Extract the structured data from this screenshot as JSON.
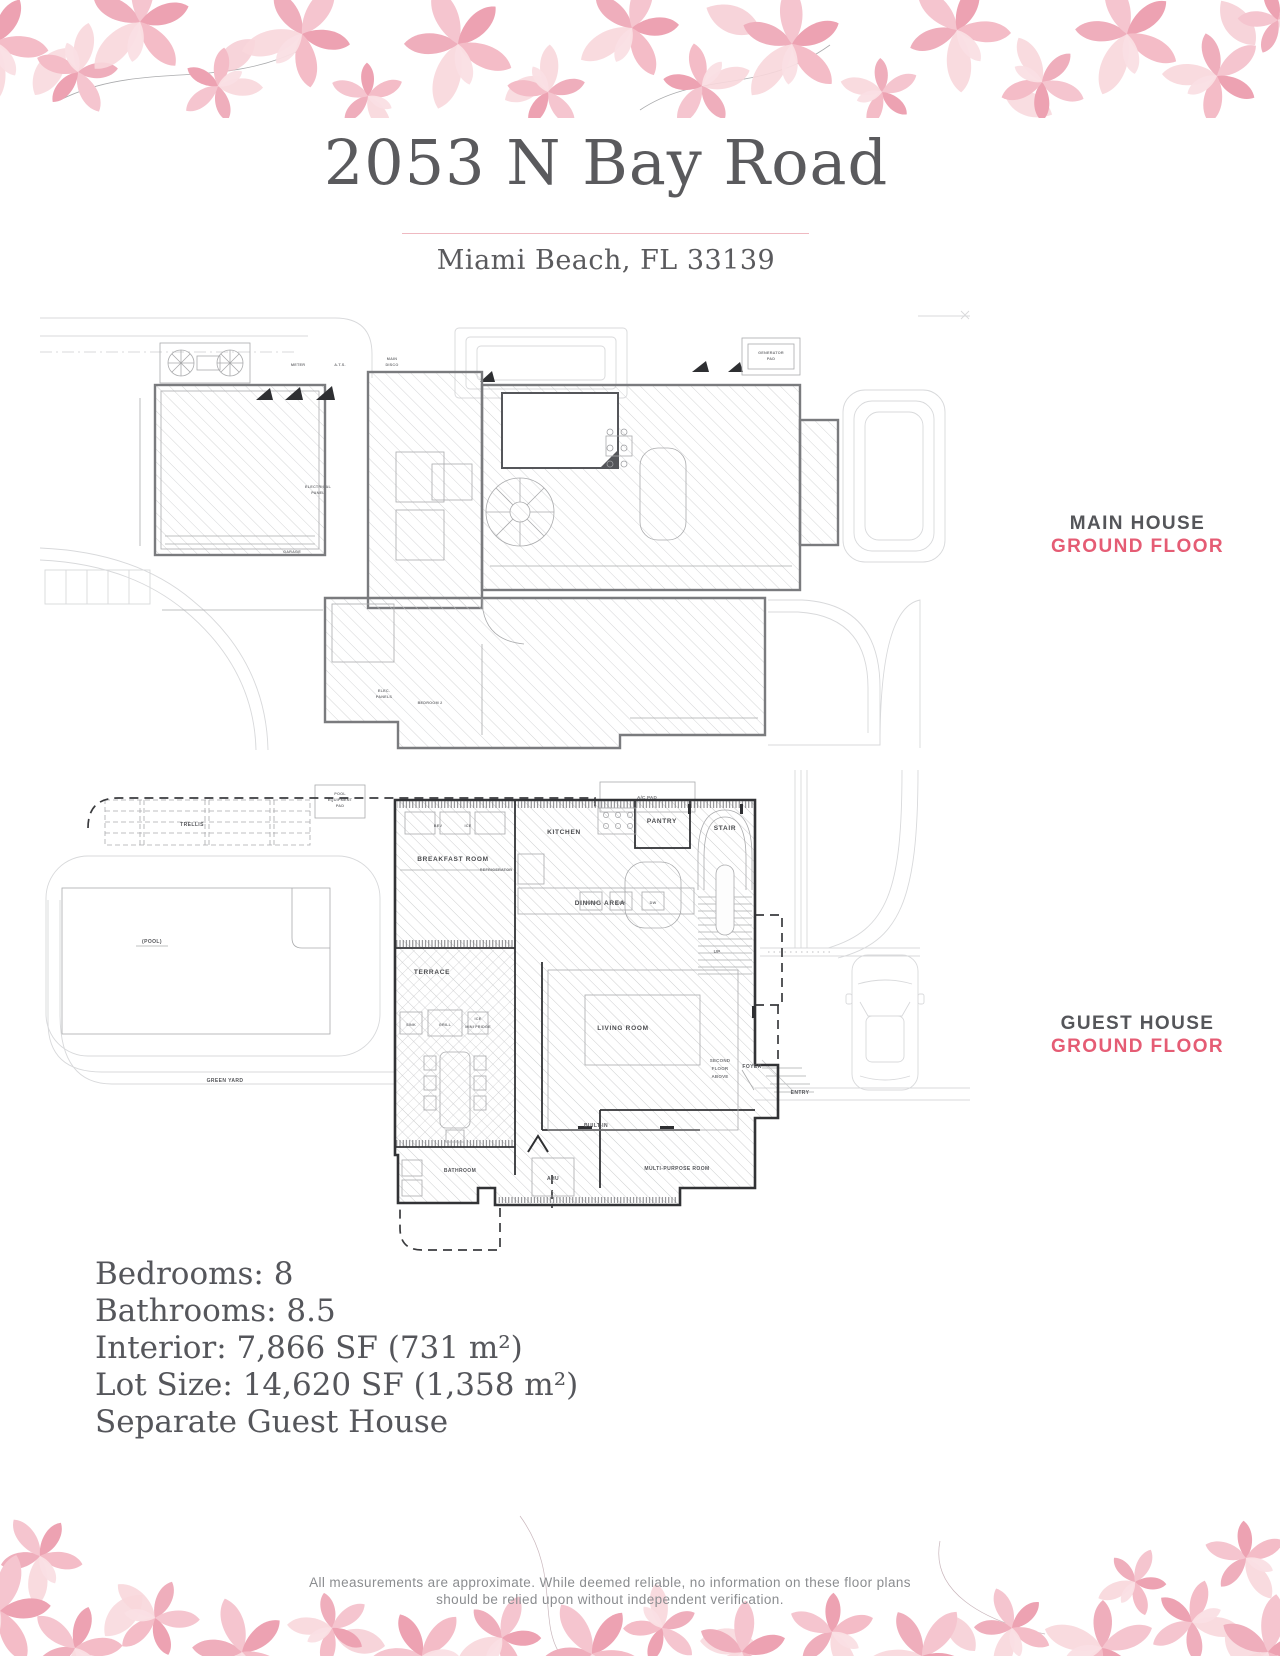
{
  "colors": {
    "accent_pink": "#e55c74",
    "heading_gray": "#5a5a5d",
    "body_text": "#55565b",
    "disclaimer_gray": "#8b8d90",
    "petal_dark": "#eda2b2",
    "petal_mid": "#f4bcc7",
    "petal_light": "#fadfe4"
  },
  "header": {
    "title": "2053 N Bay Road",
    "subtitle": "Miami Beach, FL 33139"
  },
  "plans": {
    "main_house": {
      "label_line1": "MAIN HOUSE",
      "label_line2": "GROUND FLOOR",
      "annotations": {
        "garage": "GARAGE",
        "electrical_panel_lines": [
          "ELECTRICAL",
          "PANEL"
        ],
        "elec_panels_lines": [
          "ELEC.",
          "PANELS"
        ],
        "bedroom": "BEDROOM 2",
        "generator_pad_lines": [
          "GENERATOR",
          "PAD"
        ],
        "ats": "A.T.S.",
        "meter": "METER",
        "main_disco_lines": [
          "MAIN",
          "DISCO"
        ]
      }
    },
    "guest_house": {
      "label_line1": "GUEST HOUSE",
      "label_line2": "GROUND FLOOR",
      "rooms": {
        "breakfast_room": "BREAKFAST ROOM",
        "kitchen": "KITCHEN",
        "pantry": "PANTRY",
        "stair": "STAIR",
        "up": "UP",
        "dining_area": "DINING AREA",
        "terrace": "TERRACE",
        "living_room": "LIVING ROOM",
        "built_in": "BUILT-IN",
        "foyer": "FOYER",
        "entry": "ENTRY",
        "bathroom": "BATHROOM",
        "ahu": "AHU",
        "multi_purpose_room": "MULTI-PURPOSE ROOM",
        "refrigerator": "REFRIGERATOR",
        "second_floor_lines": [
          "SECOND",
          "FLOOR",
          "ABOVE"
        ],
        "kitchen_items": [
          "TRASH",
          "SINK",
          "DW"
        ],
        "breakfast_items": [
          "BEV",
          "ICE"
        ],
        "outdoor_kitchen_items": [
          "SINK",
          "GRILL",
          "ICE",
          "MINI FRIDGE"
        ]
      },
      "site": {
        "trellis": "TRELLIS",
        "pool": "(POOL)",
        "green_yard": "GREEN YARD",
        "ac_pad": "A/C PAD",
        "pool_equipment_pad_lines": [
          "POOL",
          "EQUIPMENT",
          "PAD"
        ]
      }
    }
  },
  "details": {
    "lines": [
      "Bedrooms: 8",
      "Bathrooms: 8.5",
      "Interior: 7,866 SF (731 m²)",
      "Lot Size: 14,620 SF (1,358 m²)",
      "Separate Guest House"
    ]
  },
  "footer": {
    "disclaimer_line1": "All measurements are approximate. While deemed reliable, no information on these floor plans",
    "disclaimer_line2": "should be relied upon without independent verification."
  }
}
